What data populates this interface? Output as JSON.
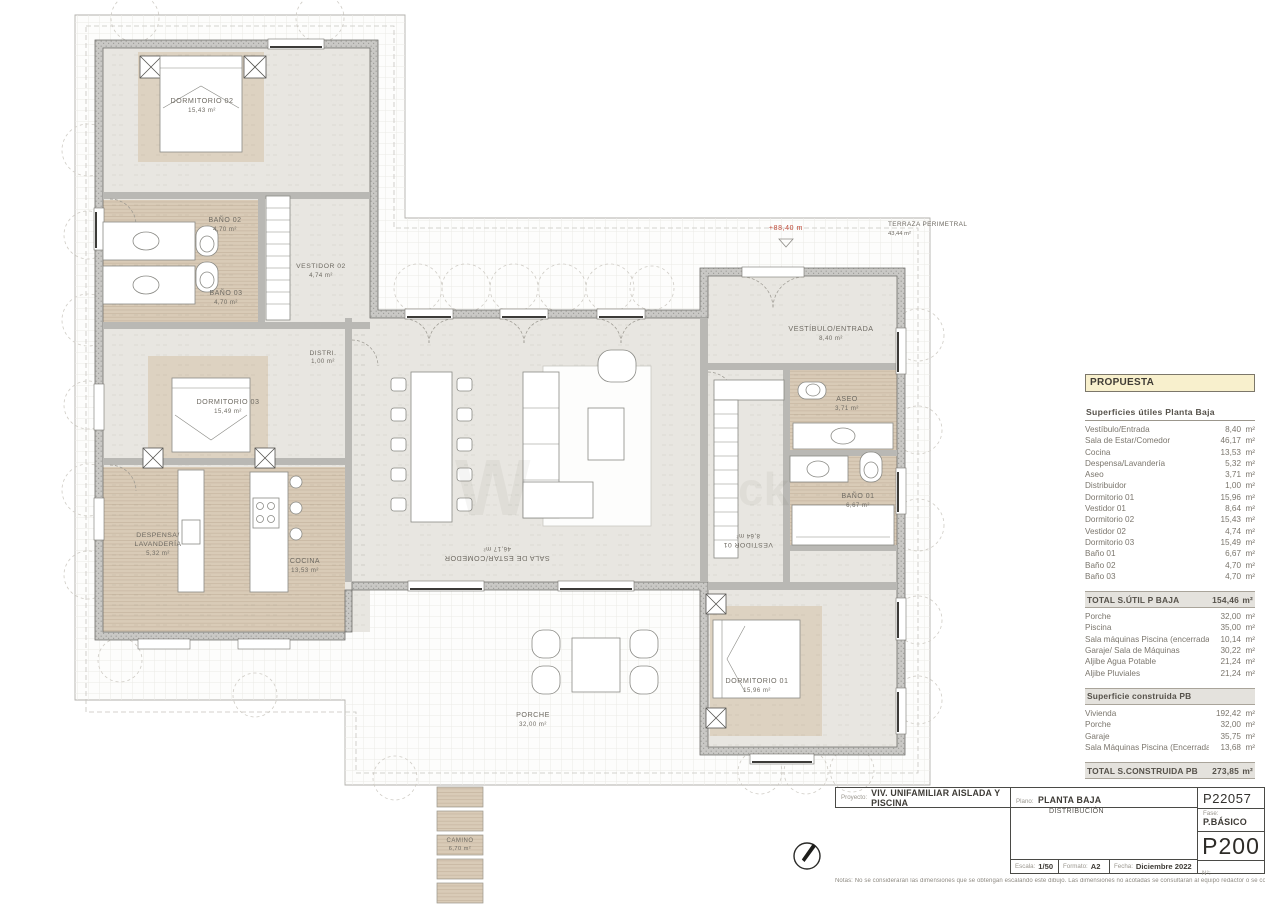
{
  "plan": {
    "rooms": [
      {
        "name": "DORMITORIO 02",
        "area": "15,43 m²"
      },
      {
        "name": "BAÑO 02",
        "area": "4,70 m²"
      },
      {
        "name": "BAÑO 03",
        "area": "4,70 m²"
      },
      {
        "name": "VESTIDOR 02",
        "area": "4,74 m²"
      },
      {
        "name": "DISTRI.",
        "area": "1,00 m²"
      },
      {
        "name": "DORMITORIO 03",
        "area": "15,49 m²"
      },
      {
        "name": "DESPENSA/",
        "name2": "LAVANDERÍA",
        "area": "5,32 m²"
      },
      {
        "name": "COCINA",
        "area": "13,53 m²"
      },
      {
        "name": "VESTÍBULO/ENTRADA",
        "area": "8,40 m²"
      },
      {
        "name": "ASEO",
        "area": "3,71 m²"
      },
      {
        "name": "BAÑO 01",
        "area": "6,67 m²"
      },
      {
        "name": "VESTIDOR 01",
        "area": "8,64 m²"
      },
      {
        "name": "SALA DE ESTAR/COMEDOR",
        "area": "46,17 m²"
      },
      {
        "name": "PORCHE",
        "area": "32,00 m²"
      },
      {
        "name": "DORMITORIO 01",
        "area": "15,96 m²"
      },
      {
        "name": "CAMINO",
        "area": "6,70 m²"
      }
    ],
    "annotations": {
      "level": "+88,40 m",
      "terraza": "TERRAZA PERIMETRAL",
      "terraza_area": "43,44 m²"
    },
    "watermark": {
      "p1": "W",
      "p2": "ck"
    }
  },
  "panel": {
    "header": "PROPUESTA",
    "section1_title": "Superficies útiles Planta Baja",
    "section1_rows": [
      {
        "label": "Vestíbulo/Entrada",
        "value": "8,40",
        "unit": "m²"
      },
      {
        "label": "Sala de Estar/Comedor",
        "value": "46,17",
        "unit": "m²"
      },
      {
        "label": "Cocina",
        "value": "13,53",
        "unit": "m²"
      },
      {
        "label": "Despensa/Lavandería",
        "value": "5,32",
        "unit": "m²"
      },
      {
        "label": "Aseo",
        "value": "3,71",
        "unit": "m²"
      },
      {
        "label": "Distribuidor",
        "value": "1,00",
        "unit": "m²"
      },
      {
        "label": "Dormitorio 01",
        "value": "15,96",
        "unit": "m²"
      },
      {
        "label": "Vestidor 01",
        "value": "8,64",
        "unit": "m²"
      },
      {
        "label": "Dormitorio 02",
        "value": "15,43",
        "unit": "m²"
      },
      {
        "label": "Vestidor 02",
        "value": "4,74",
        "unit": "m²"
      },
      {
        "label": "Dormitorio 03",
        "value": "15,49",
        "unit": "m²"
      },
      {
        "label": "Baño 01",
        "value": "6,67",
        "unit": "m²"
      },
      {
        "label": "Baño 02",
        "value": "4,70",
        "unit": "m²"
      },
      {
        "label": "Baño 03",
        "value": "4,70",
        "unit": "m²"
      }
    ],
    "total1": {
      "label": "TOTAL S.ÚTIL P BAJA",
      "value": "154,46",
      "unit": "m²"
    },
    "section2_rows": [
      {
        "label": "Porche",
        "value": "32,00",
        "unit": "m²"
      },
      {
        "label": "Piscina",
        "value": "35,00",
        "unit": "m²"
      },
      {
        "label": "Sala máquinas Piscina (encerrada)",
        "value": "10,14",
        "unit": "m²"
      },
      {
        "label": "Garaje/ Sala de Máquinas",
        "value": "30,22",
        "unit": "m²"
      },
      {
        "label": "Aljibe Agua Potable",
        "value": "21,24",
        "unit": "m²"
      },
      {
        "label": "Aljibe Pluviales",
        "value": "21,24",
        "unit": "m²"
      }
    ],
    "section3_title": "Superficie construida PB",
    "section3_rows": [
      {
        "label": "Vivienda",
        "value": "192,42",
        "unit": "m²"
      },
      {
        "label": "Porche",
        "value": "32,00",
        "unit": "m²"
      },
      {
        "label": "Garaje",
        "value": "35,75",
        "unit": "m²"
      },
      {
        "label": "Sala Máquinas Piscina (Encerrada)",
        "value": "13,68",
        "unit": "m²"
      }
    ],
    "total2": {
      "label": "TOTAL S.CONSTRUIDA PB",
      "value": "273,85",
      "unit": "m²"
    }
  },
  "titleblock": {
    "proyecto_label": "Proyecto:",
    "proyecto": "VIV. UNIFAMILIAR AISLADA Y PISCINA",
    "plano_label": "Plano:",
    "plano": "PLANTA BAJA",
    "plano_sub": "DISTRIBUCIÓN",
    "code": "P22057",
    "fase_label": "Fase:",
    "fase": "P.BÁSICO",
    "sheet": "P200",
    "escala_label": "Escala:",
    "escala": "1/50",
    "formato_label": "Formato:",
    "formato": "A2",
    "fecha_label": "Fecha:",
    "fecha": "Diciembre 2022",
    "num_label": "N°:",
    "notas": "Notas: No se considerarán las dimensiones que se obtengan escalando este dibujo. Las dimensiones no acotadas se consultarán al equipo redactor o se comprobarán con la dirección facultativa."
  },
  "colors": {
    "tile": "#d9cbb7",
    "wall": "#c9c8c5",
    "floor": "#e8e6e1",
    "accent_red": "#bf4a38",
    "header_yellow": "#f8f0cd"
  }
}
